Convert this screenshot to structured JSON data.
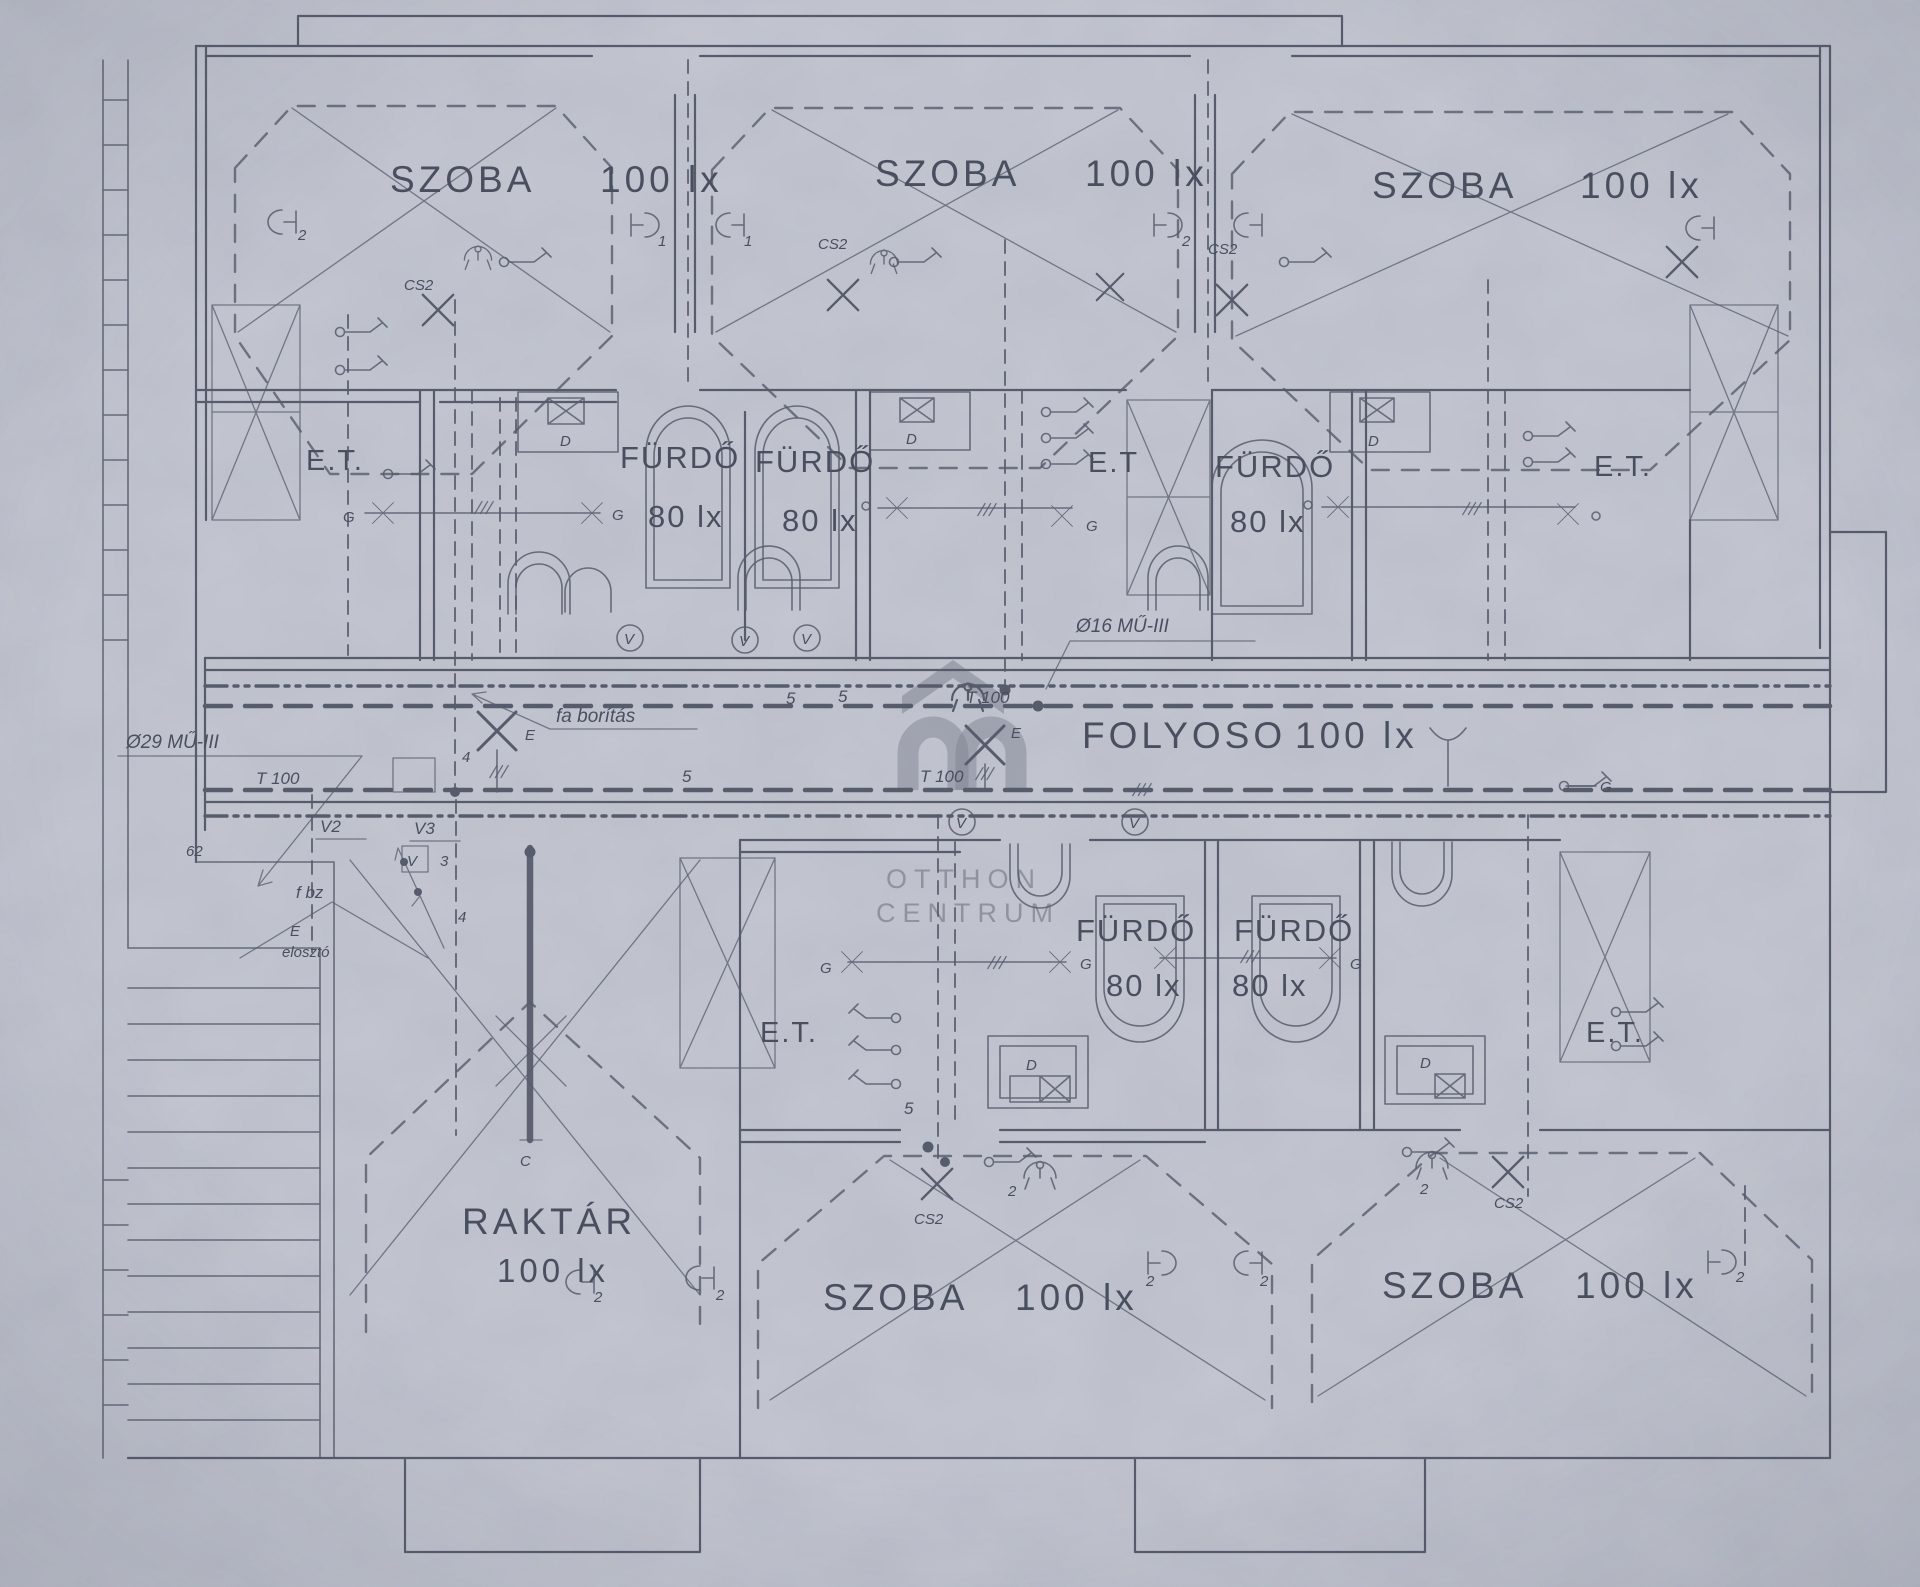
{
  "drawing": {
    "rooms": {
      "szoba_top_left": {
        "name": "SZOBA",
        "lux": "100 lx"
      },
      "szoba_top_middle": {
        "name": "SZOBA",
        "lux": "100 lx"
      },
      "szoba_top_right": {
        "name": "SZOBA",
        "lux": "100 lx"
      },
      "furdo_top_1": {
        "name": "FÜRDŐ",
        "lux": "80 lx"
      },
      "furdo_top_2": {
        "name": "FÜRDŐ",
        "lux": "80 lx"
      },
      "furdo_top_3": {
        "name": "FÜRDŐ",
        "lux": "80 lx"
      },
      "folyoso": {
        "name": "FOLYOSO",
        "lux": "100 lx"
      },
      "raktar": {
        "name": "RAKTÁR",
        "lux": "100 lx"
      },
      "furdo_bottom_1": {
        "name": "FÜRDŐ",
        "lux": "80 lx"
      },
      "furdo_bottom_2": {
        "name": "FÜRDŐ",
        "lux": "80 lx"
      },
      "szoba_bottom_left": {
        "name": "SZOBA",
        "lux": "100 lx"
      },
      "szoba_bottom_right": {
        "name": "SZOBA",
        "lux": "100 lx"
      }
    },
    "et": {
      "left": "E.T.",
      "middle": "E.T",
      "right": "E.T.",
      "bottom_left": "E.T.",
      "bottom_right": "E.T."
    },
    "ann": {
      "pipe_left": "Ø29 MŰ-III",
      "pipe_right": "Ø16 MŰ-III",
      "t100": "T 100",
      "fa_boritas": "fa borítás",
      "cs2": "CS2",
      "v2": "V2",
      "v3": "V3",
      "v": "V",
      "n3": "3",
      "n62": "62",
      "n5": "5",
      "n2": "2",
      "n4": "4",
      "n1": "1",
      "fbz": "f bz",
      "e": "E",
      "eloszto": "elosztó",
      "g": "G",
      "d": "D",
      "c": "C"
    },
    "watermark": {
      "line1": "OTTHON",
      "line2": "CENTRUM"
    },
    "colors": {
      "paper": "#c5c8d2",
      "ink": "#575c6c",
      "text": "#4a4f60",
      "watermark": "#7f8391"
    }
  }
}
